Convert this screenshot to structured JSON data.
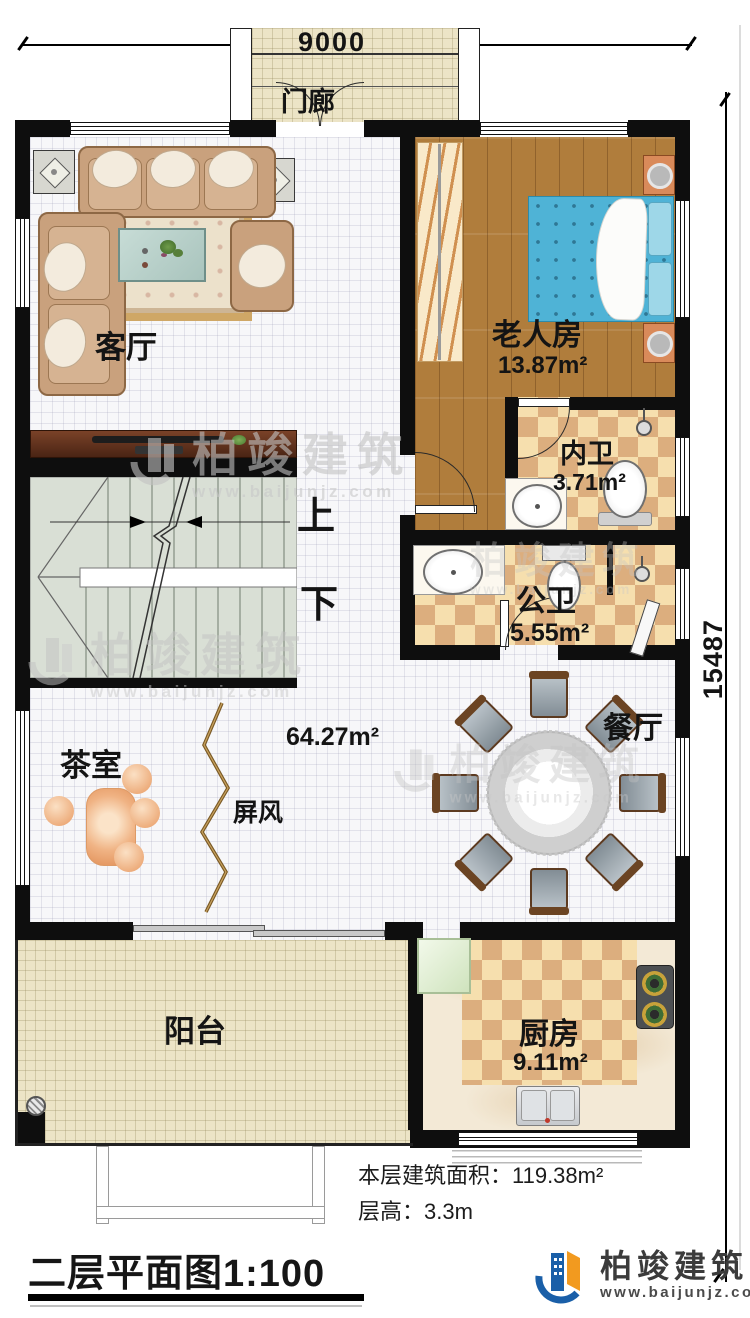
{
  "dimensions": {
    "width_label": "9000",
    "height_label": "15487"
  },
  "rooms": {
    "porch": {
      "label": "门廊"
    },
    "living_room": {
      "label": "客厅"
    },
    "elder_room": {
      "label": "老人房",
      "area": "13.87m²"
    },
    "inner_bathroom": {
      "label": "内卫",
      "area": "3.71m²"
    },
    "public_bathroom": {
      "label": "公卫",
      "area": "5.55m²"
    },
    "stairs": {
      "up_label": "上",
      "down_label": "下"
    },
    "hall": {
      "area": "64.27m²"
    },
    "dining_room": {
      "label": "餐厅"
    },
    "tea_room": {
      "label": "茶室"
    },
    "screen": {
      "label": "屏风"
    },
    "balcony": {
      "label": "阳台"
    },
    "kitchen": {
      "label": "厨房",
      "area": "9.11m²"
    }
  },
  "notes": {
    "floor_area": "本层建筑面积：119.38m²",
    "floor_height": "层高：3.3m"
  },
  "title": "二层平面图1:100",
  "brand": {
    "name": "柏竣建筑",
    "website": "www.baijunjz.com"
  },
  "watermark": {
    "name": "柏竣建筑",
    "website": "www.baijunjz.com"
  },
  "colors": {
    "wall": "#0e0e0e",
    "bed": "#4fb3d6",
    "tile_dark": "#dcae7e",
    "tile_light": "#f6dfae",
    "wood": "#b07d3c",
    "brand_blue": "#1a5fa8",
    "brand_orange": "#f29a1f"
  }
}
